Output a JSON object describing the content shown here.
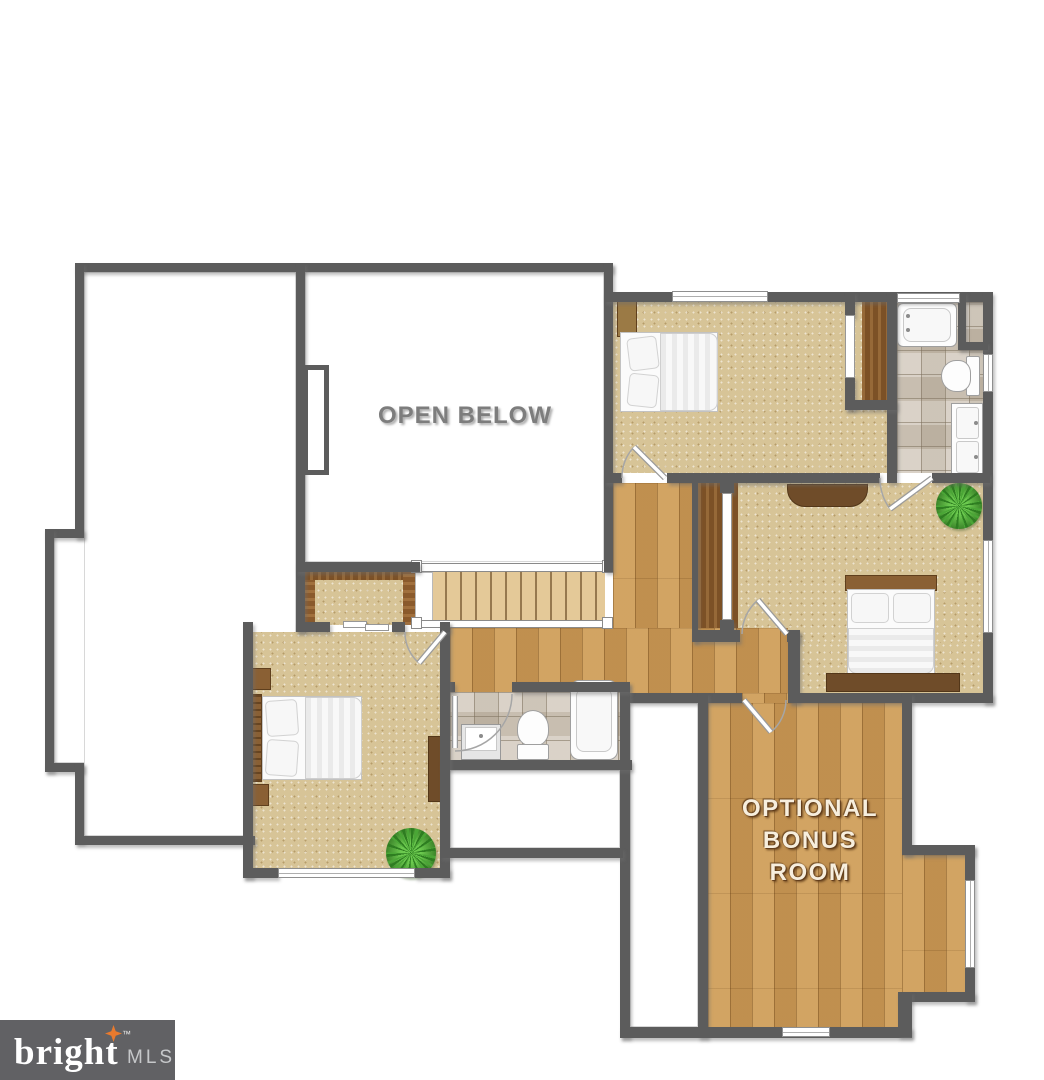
{
  "labels": {
    "open_below": "OPEN BELOW",
    "bonus": [
      "OPTIONAL",
      "BONUS",
      "ROOM"
    ]
  },
  "logo": {
    "brand": "bright",
    "trademark": "™",
    "suffix": "MLS"
  },
  "colors": {
    "wall": "#5c5c5c",
    "carpet": "#d7c497",
    "hall_wood": "#cb9a57",
    "stair_wood": "#e4c998",
    "closet_wood": "#7c5126",
    "tile": "#cdc3b4",
    "label_gray": "#7d7d7d",
    "label_cream": "#f7eedd",
    "logo_bg": "#616164",
    "logo_accent": "#e87a2e"
  }
}
